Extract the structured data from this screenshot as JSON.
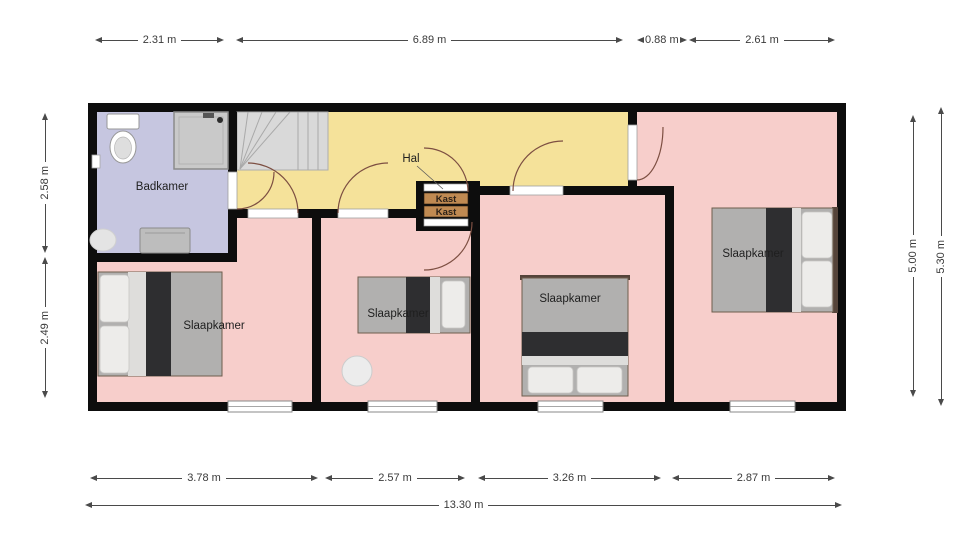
{
  "floorplan": {
    "rooms": {
      "badkamer": {
        "label": "Badkamer"
      },
      "hal": {
        "label": "Hal"
      },
      "kast_top": {
        "label": "Kast"
      },
      "kast_bottom": {
        "label": "Kast"
      },
      "slaapkamer_sw": {
        "label": "Slaapkamer"
      },
      "slaapkamer_s": {
        "label": "Slaapkamer"
      },
      "slaapkamer_se": {
        "label": "Slaapkamer"
      },
      "slaapkamer_e": {
        "label": "Slaapkamer"
      }
    },
    "colors": {
      "bedroom": "#f7cecb",
      "hall": "#f5e29a",
      "bathroom": "#c6c6e0",
      "wall": "#0d0d0d",
      "closet": "#c08a52",
      "stairs": "#d9d9d9"
    }
  },
  "dimensions": {
    "top": [
      "2.31 m",
      "6.89 m",
      "0.88 m",
      "2.61 m"
    ],
    "bottom": [
      "3.78 m",
      "2.57 m",
      "3.26 m",
      "2.87 m"
    ],
    "bottom_total": "13.30 m",
    "left": [
      "2.58 m",
      "2.49 m"
    ],
    "right": [
      "5.00 m",
      "5.30 m"
    ]
  }
}
